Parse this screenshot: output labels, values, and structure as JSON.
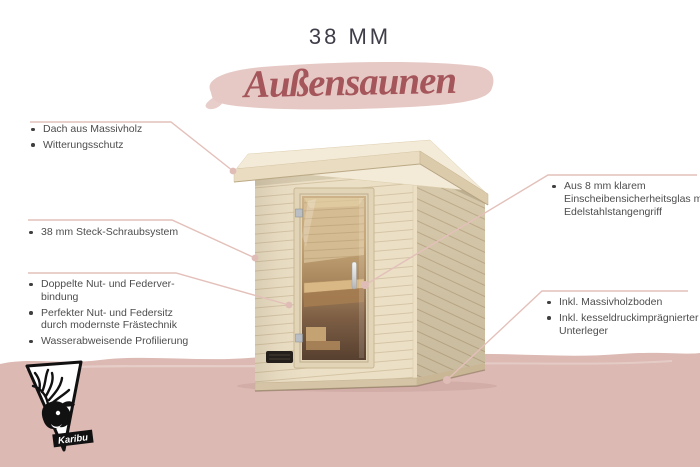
{
  "header": {
    "thickness": "38 MM",
    "title": "Außensaunen"
  },
  "callouts": {
    "left": [
      {
        "items": [
          "Dach aus Massivholz",
          "Witterungsschutz"
        ]
      },
      {
        "items": [
          "38 mm Steck-Schraubsystem"
        ]
      },
      {
        "items": [
          "Doppelte Nut- und Federver­bindung",
          "Perfekter Nut- und Federsitz durch modernste Frästechnik",
          "Wasserabweisende Profilierung"
        ]
      }
    ],
    "right": [
      {
        "items": [
          "Aus 8 mm klarem Einscheiben­sicherheitsglas mit Edelstahlstangengriff"
        ]
      },
      {
        "items": [
          "Inkl. Massivholzboden",
          "Inkl. kesseldruckimprägnierter Unterleger"
        ]
      }
    ]
  },
  "logo": {
    "brand": "Karibu"
  },
  "colors": {
    "accent_text": "#a5565b",
    "title_brush": "#e6c9c5",
    "bottom_band": "#dcb9b3",
    "callout_line": "#e3c0ba",
    "heading_text": "#3f3e48",
    "body_text": "#4d4d4d",
    "sauna_wood": "#ebdfc5"
  }
}
